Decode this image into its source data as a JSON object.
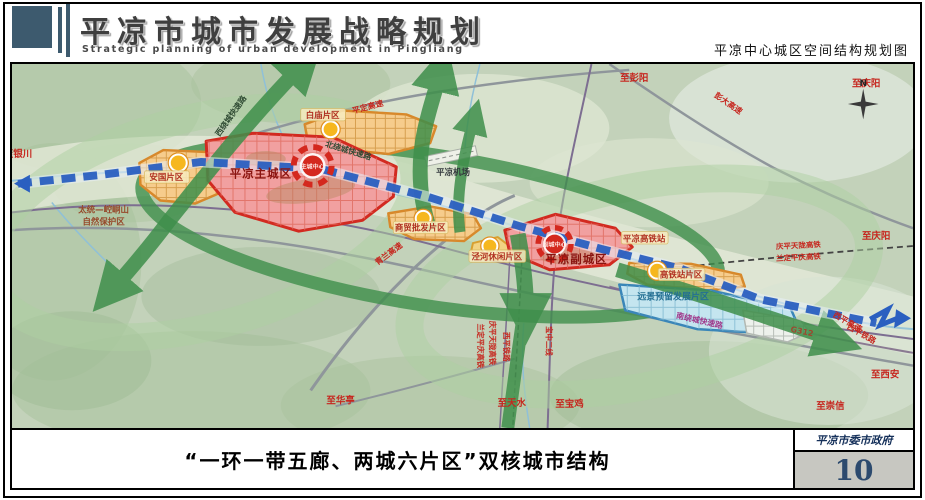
{
  "header": {
    "title": "平凉市城市发展战略规划",
    "subtitle": "Strategic planning of urban development in Pingliang",
    "map_title": "平凉中心城区空间结构规划图"
  },
  "footer": {
    "caption": "“一环一带五廊、两城六片区”双核城市结构",
    "agency": "平凉市委市政府",
    "page_number": "10"
  },
  "map": {
    "compass": "N",
    "districts": {
      "main_city": "平凉主城区",
      "sub_city": "平凉副城区"
    },
    "cores": {
      "main": "主城中心",
      "sub": "副城中心"
    },
    "zones": {
      "anguo": "安国片区",
      "baimiao": "白庙片区",
      "shangmao": "商贸批发片区",
      "jinghe": "泾河休闲片区",
      "gaotiezhan": "高铁站片区",
      "reserve": "远景预留发展片区"
    },
    "nature_reserve_line1": "太统—崆峒山",
    "nature_reserve_line2": "自然保护区",
    "facilities": {
      "airport": "平凉机场",
      "hsr_station": "平凉高铁站"
    },
    "roads": {
      "pingding": "平定高速",
      "pengda": "彭大高速",
      "qinglan": "青兰高速",
      "west_ring": "西绕城快速路",
      "north_ring": "北绕城快速路",
      "south_ring": "南绕城快速路",
      "g312": "G312",
      "xiping_expwy": "西平高速"
    },
    "railways": {
      "qptl_hsr": "庆平天陇高铁",
      "ldpq_hsr": "兰定平庆高铁",
      "xiping_rail": "西平铁路",
      "baozhong2": "宝中二线"
    },
    "directions": {
      "yinchuan": "至银川",
      "pengyang": "至彭阳",
      "qingyang_top": "至庆阳",
      "qingyang_right": "至庆阳",
      "huating": "至华亭",
      "tianshui": "至天水",
      "baoji": "至宝鸡",
      "chongxin": "至崇信",
      "xian": "至西安"
    },
    "colors": {
      "corridor_green": "#3f8f4b",
      "axis_blue": "#2a5fc0",
      "core_red": "#d4281e",
      "zone_orange": "#d8882a",
      "reserve_blue": "#3a86b8",
      "terrain": "#c3d2ba"
    }
  }
}
